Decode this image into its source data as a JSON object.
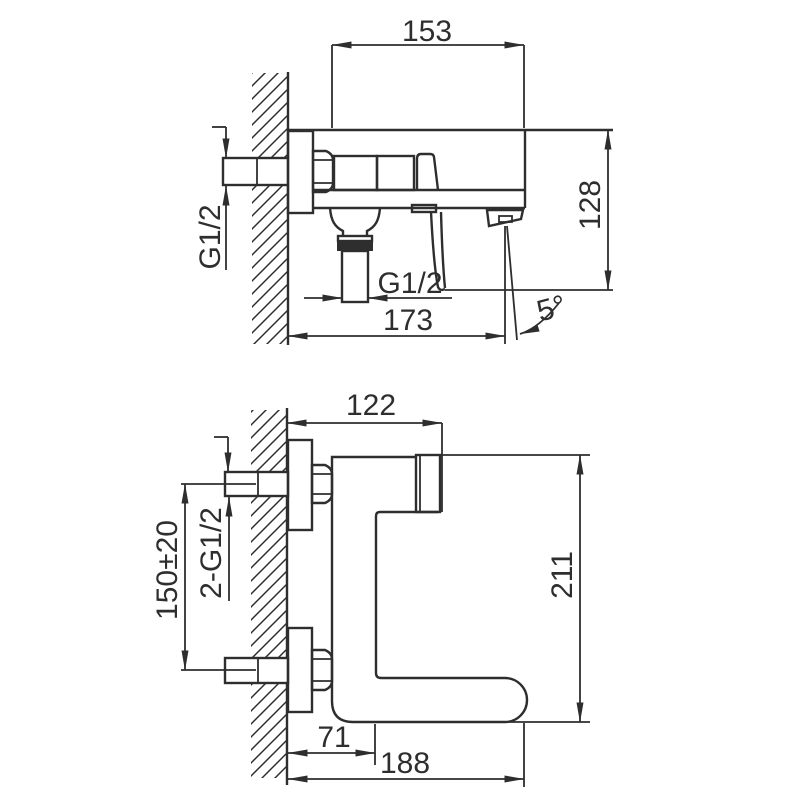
{
  "colors": {
    "line": "#2e2e2e",
    "background": "#ffffff"
  },
  "side_view": {
    "top_width": "153",
    "right_height": "128",
    "inlet_thread": "G1/2",
    "outlet_thread": "G1/2",
    "bottom_width": "173",
    "handle_angle": "5°"
  },
  "front_view": {
    "top_width": "122",
    "connection_spacing": "150±20",
    "connection_thread": "2-G1/2",
    "right_height": "211",
    "wall_to_front": "71",
    "spout_reach": "188"
  }
}
